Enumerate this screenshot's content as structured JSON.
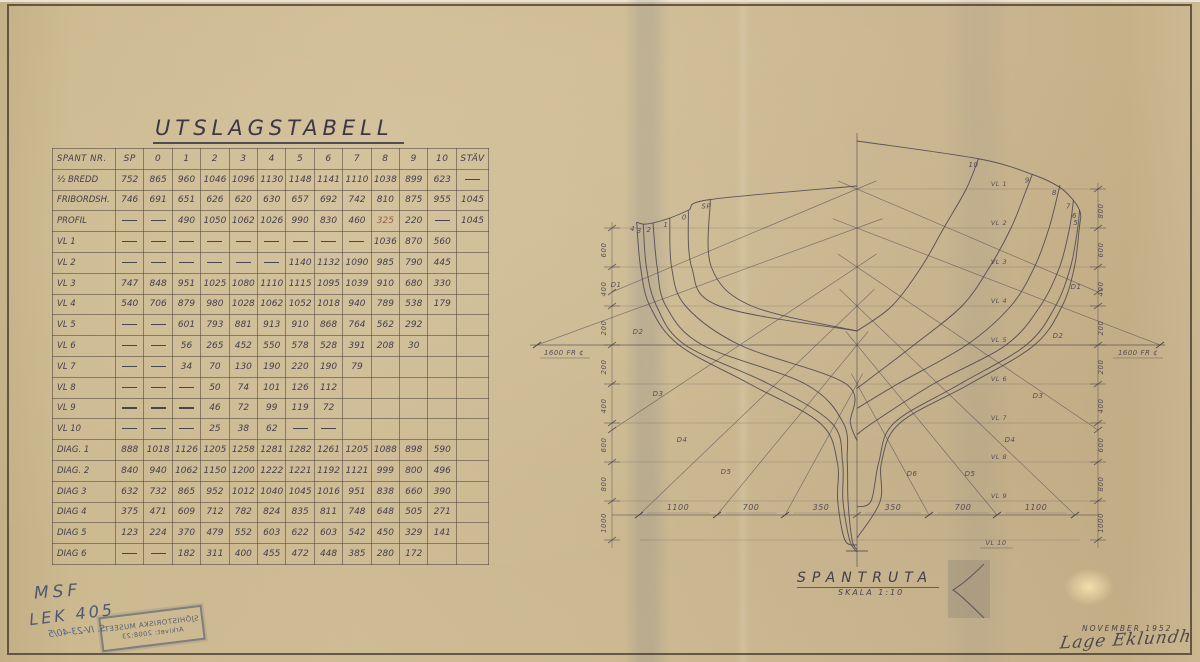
{
  "title": "UTSLAGSTABELL",
  "chart_data": {
    "type": "table",
    "columns": [
      "SPANT NR.",
      "SP",
      "0",
      "1",
      "2",
      "3",
      "4",
      "5",
      "6",
      "7",
      "8",
      "9",
      "10",
      "STÄV"
    ],
    "rows": [
      {
        "label": "½ BREDD",
        "values": [
          "752",
          "865",
          "960",
          "1046",
          "1096",
          "1130",
          "1148",
          "1141",
          "1110",
          "1038",
          "899",
          "623",
          "—"
        ]
      },
      {
        "label": "FRIBORDSH.",
        "values": [
          "746",
          "691",
          "651",
          "626",
          "620",
          "630",
          "657",
          "692",
          "742",
          "810",
          "875",
          "955",
          "1045"
        ]
      },
      {
        "label": "PROFIL",
        "values": [
          "—",
          "—",
          "490",
          "1050",
          "1062",
          "1026",
          "990",
          "830",
          "460",
          "325",
          "220",
          "—",
          "1045"
        ],
        "accent_index": 9
      },
      {
        "label": "VL 1",
        "values": [
          "—",
          "—",
          "—",
          "—",
          "—",
          "—",
          "—",
          "—",
          "—",
          "1036",
          "870",
          "560",
          ""
        ]
      },
      {
        "label": "VL 2",
        "values": [
          "—",
          "—",
          "—",
          "—",
          "—",
          "—",
          "1140",
          "1132",
          "1090",
          "985",
          "790",
          "445",
          ""
        ]
      },
      {
        "label": "VL 3",
        "values": [
          "747",
          "848",
          "951",
          "1025",
          "1080",
          "1110",
          "1115",
          "1095",
          "1039",
          "910",
          "680",
          "330",
          ""
        ]
      },
      {
        "label": "VL 4",
        "values": [
          "540",
          "706",
          "879",
          "980",
          "1028",
          "1062",
          "1052",
          "1018",
          "940",
          "789",
          "538",
          "179",
          ""
        ]
      },
      {
        "label": "VL 5",
        "values": [
          "—",
          "—",
          "601",
          "793",
          "881",
          "913",
          "910",
          "868",
          "764",
          "562",
          "292",
          "",
          ""
        ]
      },
      {
        "label": "VL 6",
        "values": [
          "—",
          "—",
          "56",
          "265",
          "452",
          "550",
          "578",
          "528",
          "391",
          "208",
          "30",
          "",
          ""
        ]
      },
      {
        "label": "VL 7",
        "values": [
          "—",
          "—",
          "34",
          "70",
          "130",
          "190",
          "220",
          "190",
          "79",
          "",
          "",
          "",
          ""
        ]
      },
      {
        "label": "VL 8",
        "values": [
          "—",
          "—",
          "—",
          "50",
          "74",
          "101",
          "126",
          "112",
          "",
          "",
          "",
          "",
          ""
        ]
      },
      {
        "label": "VL 9",
        "values": [
          "—",
          "—",
          "—",
          "46",
          "72",
          "99",
          "119",
          "72",
          "",
          "",
          "",
          "",
          ""
        ]
      },
      {
        "label": "VL 10",
        "values": [
          "—",
          "—",
          "—",
          "25",
          "38",
          "62",
          "—",
          "—",
          "",
          "",
          "",
          "",
          ""
        ]
      },
      {
        "label": "DIAG. 1",
        "values": [
          "888",
          "1018",
          "1126",
          "1205",
          "1258",
          "1281",
          "1282",
          "1261",
          "1205",
          "1088",
          "898",
          "590",
          ""
        ]
      },
      {
        "label": "DIAG. 2",
        "values": [
          "840",
          "940",
          "1062",
          "1150",
          "1200",
          "1222",
          "1221",
          "1192",
          "1121",
          "999",
          "800",
          "496",
          ""
        ]
      },
      {
        "label": "DIAG 3",
        "values": [
          "632",
          "732",
          "865",
          "952",
          "1012",
          "1040",
          "1045",
          "1016",
          "951",
          "838",
          "660",
          "390",
          ""
        ]
      },
      {
        "label": "DIAG 4",
        "values": [
          "375",
          "471",
          "609",
          "712",
          "782",
          "824",
          "835",
          "811",
          "748",
          "648",
          "505",
          "271",
          ""
        ]
      },
      {
        "label": "DIAG 5",
        "values": [
          "123",
          "224",
          "370",
          "479",
          "552",
          "603",
          "622",
          "603",
          "542",
          "450",
          "329",
          "141",
          ""
        ]
      },
      {
        "label": "DIAG 6",
        "values": [
          "—",
          "—",
          "182",
          "311",
          "400",
          "455",
          "472",
          "448",
          "385",
          "280",
          "172",
          "",
          ""
        ]
      }
    ]
  },
  "drawing": {
    "title": "SPANTRUTA",
    "scale": "SKALA 1:10",
    "vl_labels": [
      "VL 1",
      "VL 2",
      "VL 3",
      "VL 4",
      "VL 5",
      "VL 6",
      "VL 7",
      "VL 8",
      "VL 9",
      "VL 10"
    ],
    "diag_labels": [
      "D1",
      "D2",
      "D3",
      "D4",
      "D5",
      "D6"
    ],
    "dims_bottom": [
      "1100",
      "700",
      "350",
      "350",
      "700",
      "1100"
    ],
    "dims_left": [
      "600",
      "400",
      "200",
      "200",
      "400",
      "600",
      "800",
      "1000"
    ],
    "dims_right": [
      "800",
      "600",
      "400",
      "200",
      "200",
      "400",
      "600",
      "800",
      "1000"
    ],
    "ref_left": "1600 FR ¢",
    "ref_right": "1600 FR ¢"
  },
  "annotations": {
    "msf": "MSF",
    "lek": "LEK 405",
    "stamp_line1": "SJÖHISTORISKA MUSEET",
    "stamp_line2": "Arkivet: 2008:23",
    "stamp_note": "S. IV-23-40/5",
    "date": "NOVEMBER 1952",
    "signature": "Lage Eklundh"
  }
}
